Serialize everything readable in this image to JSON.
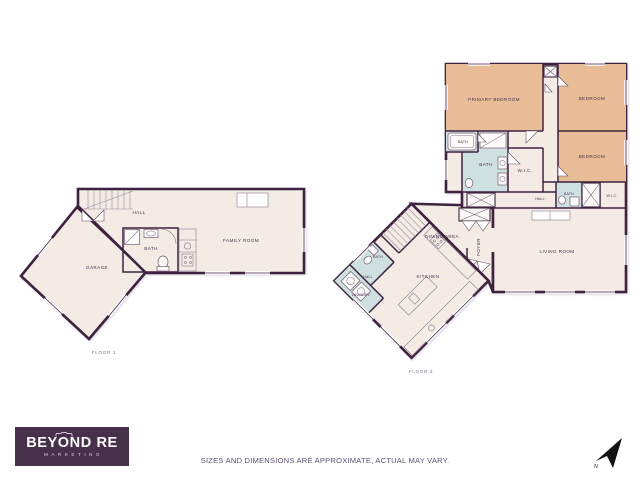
{
  "colors": {
    "wall": "#3e2340",
    "room": "#f3ebe4",
    "bedroom": "#e7bc96",
    "bath": "#cfe0e0",
    "logo_bg": "#47304a",
    "label": "#4a3148",
    "muted": "#7a6d80",
    "disclaimer": "#5d5370"
  },
  "logo": {
    "brand": "BEYOND RE",
    "tagline": "MARKETING"
  },
  "footer": {
    "disclaimer": "SIZES AND DIMENSIONS ARE APPROXIMATE, ACTUAL MAY VARY."
  },
  "compass": {
    "north": "N"
  },
  "floor1": {
    "title": "FLOOR 1",
    "labels": {
      "garage": "GARAGE",
      "hall": "HALL",
      "bath": "BATH",
      "family_room": "FAMILY ROOM"
    }
  },
  "floor2": {
    "title": "FLOOR 2",
    "labels": {
      "primary_bedroom": "PRIMARY BEDROOM",
      "bedroom_top": "BEDROOM",
      "bedroom_mid": "BEDROOM",
      "bath_small": "BATH",
      "bath_main": "BATH",
      "wic_main": "W.I.C.",
      "hall_upper": "HALL",
      "bath_right": "BATH",
      "wic_right": "W.I.C.",
      "living_room": "LIVING ROOM",
      "dining_area": "DINING AREA",
      "foyer": "FOYER",
      "kitchen": "KITCHEN",
      "bath_lower": "BATH",
      "hall_lower": "HALL",
      "laundry": "LAUNDRY"
    }
  }
}
